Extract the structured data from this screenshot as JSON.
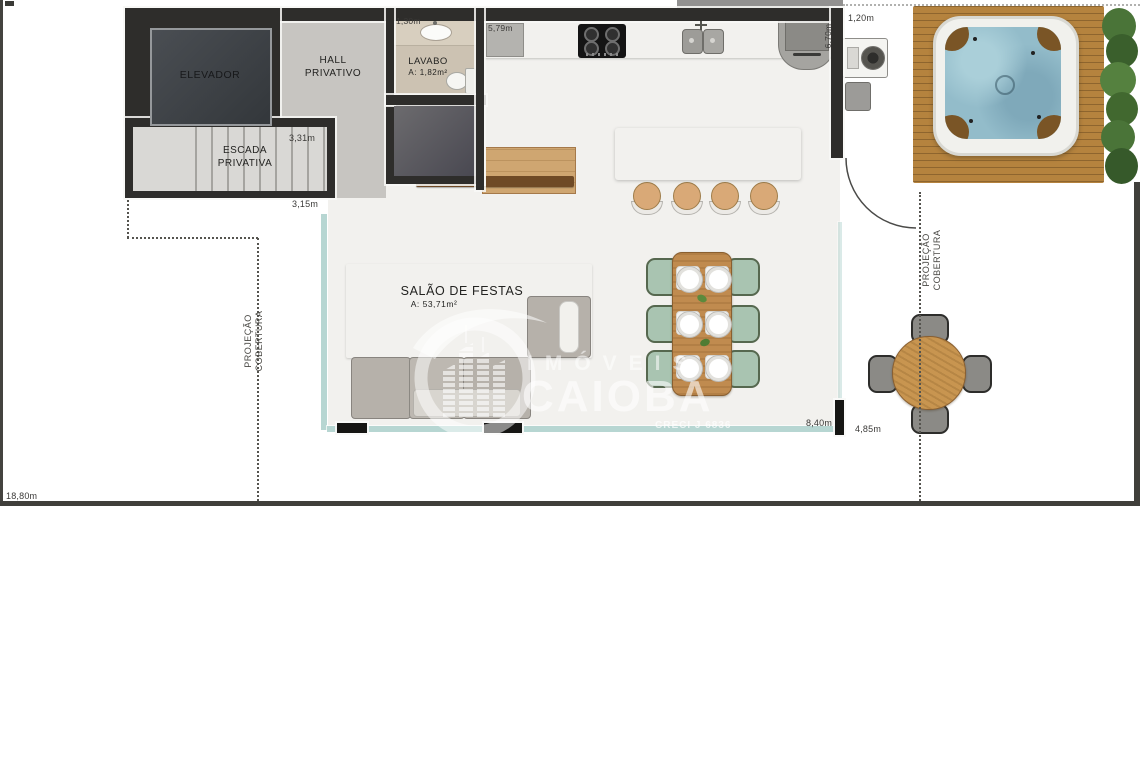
{
  "plan": {
    "rooms": {
      "elevator": "ELEVADOR",
      "stairs_line1": "ESCADA",
      "stairs_line2": "PRIVATIVA",
      "hall_line1": "HALL",
      "hall_line2": "PRIVATIVO",
      "lavabo": "LAVABO",
      "lavabo_area": "A: 1,82m²",
      "salao": "SALÃO DE FESTAS",
      "salao_area": "A: 53,71m²"
    },
    "dimensions": {
      "lavabo_width": "1,30m",
      "kitchen_width": "5,79m",
      "kitchen_depth": "6,70m",
      "terrace_gap": "1,20m",
      "stairs_upper": "3,31m",
      "stairs_lower": "3,15m",
      "salao_width": "8,40m",
      "terrace_width": "4,85m",
      "total_width": "18,80m"
    },
    "projection": {
      "left": "PROJEÇÃO COBERTURA",
      "right": "PROJEÇÃO COBERTURA"
    }
  },
  "watermark": {
    "brand_top": "IMÓVEIS",
    "brand_main": "CAIOBA",
    "creci": "CRECI J 6836"
  },
  "colors": {
    "wall": "#2e2d2b",
    "floor": "#c9c8c4",
    "deck_wood": "#b5833e",
    "furniture_wood": "#c08b4f",
    "spa_water": "#93bcca",
    "dining_chair_green": "#a9c4b1",
    "glass_railing": "#b7d6d2",
    "plant_green": "#4a7438",
    "marble": "#eae9e4"
  }
}
